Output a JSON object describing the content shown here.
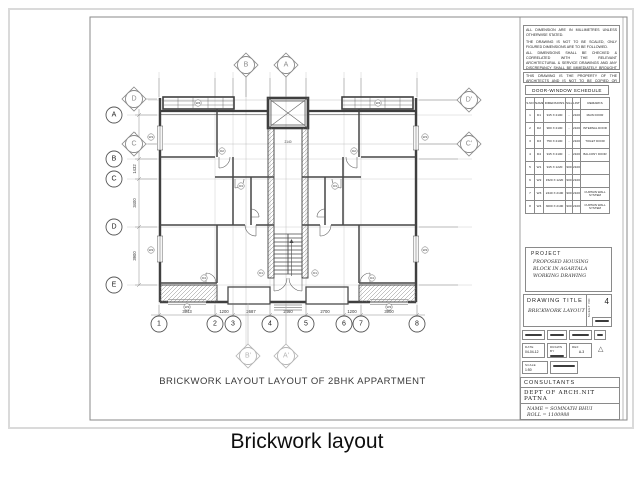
{
  "caption": "Brickwork layout",
  "colors": {
    "line": "#3f3f3f",
    "grid": "#b8b8b8",
    "marker_gray": "#8a8a8a",
    "marker_light": "#b5b5b5",
    "scan_border": "#dadada"
  },
  "sheet": {
    "plan_title": "BRICKWORK LAYOUT  LAYOUT OF 2BHK APPARTMENT",
    "notes_block1": [
      "ALL DIMENSION ARE IN MILLIMETRES UNLESS OTHERWISE STATED.",
      "THE DRAWING IS NOT TO BE SCALED, ONLY FIGURED DIMENSIONS ARE TO BE FOLLOWED.",
      "ALL DIMENSIONS SHALL BE CHECKED & CORRELATED WITH THE RELEVANT ARCHITECTURAL & SERVICE DRAWINGS AND ANY DISCREPANCY SHALL BE IMMEDIATELY BROUGHT TO THE NOTICE OF THE ARCHITECT BEFORE COMMENCEMENT OF THE WORK AT SITE."
    ],
    "notes_block2": "THIS DRAWING IS THE PROPERTY OF THE ARCHITECTS AND IS NOT TO BE COPIED OR REPRODUCED WITHOUT WRITTEN PERMISSION.",
    "schedule": {
      "title": "DOOR-WINDOW SCHEDULE",
      "columns": [
        "S.NO",
        "NAME",
        "DIMENSIONS",
        "SILL",
        "LINTEL",
        "REMARKS"
      ],
      "rows": [
        [
          "1",
          "D1",
          "915 X 2100",
          "-",
          "2100",
          "MAIN DOOR"
        ],
        [
          "2",
          "D2",
          "900 X 2100",
          "-",
          "2100",
          "INTERNAL DOOR"
        ],
        [
          "3",
          "D3",
          "750 X 2100",
          "-",
          "2100",
          "TOILET DOOR"
        ],
        [
          "4",
          "D4",
          "915 X 2100",
          "-",
          "2100",
          "BALCONY DOOR"
        ],
        [
          "5",
          "W1",
          "915 X 1220",
          "900",
          "2100",
          ""
        ],
        [
          "6",
          "W2",
          "1520 X 1220",
          "900",
          "2100",
          ""
        ],
        [
          "7",
          "W3",
          "2440 X 2100",
          "900",
          "2100",
          "CURTAIN WALL SYSTEM"
        ],
        [
          "8",
          "W4",
          "3000 X 2100",
          "900",
          "2100",
          "CURTAIN WALL SYSTEM"
        ]
      ]
    },
    "project": {
      "label": "PROJECT",
      "lines": [
        "PROPOSED HOUSING",
        "BLOCK IN AGARTALA",
        "WORKING DRAWING"
      ]
    },
    "drawing_title": {
      "label": "DRAWING TITLE",
      "title": "BRICKWORK LAYOUT",
      "sheet_no": "4",
      "sheet_no_label": "SHEET NO"
    },
    "revision": {
      "date_label": "DATE",
      "date": "04-04-12",
      "drawn_label": "DRAWN BY",
      "ref_label": "REF",
      "ref": "A-3",
      "scale_label": "SCALE",
      "scale": "1:50"
    },
    "consultants": {
      "label": "CONSULTANTS",
      "dept": "DEPT OF ARCH.NIT PATNA",
      "name_line": "NAME = SOMNATH BHUI",
      "roll_line": "ROLL = 1100988",
      "sem_line": "SEM. = 8"
    },
    "grid": {
      "bottom": [
        {
          "label": "1",
          "x": 149
        },
        {
          "label": "2",
          "x": 205
        },
        {
          "label": "3",
          "x": 223
        },
        {
          "label": "4",
          "x": 260
        },
        {
          "label": "5",
          "x": 296
        },
        {
          "label": "6",
          "x": 334
        },
        {
          "label": "7",
          "x": 351
        },
        {
          "label": "8",
          "x": 407
        }
      ],
      "left": [
        {
          "label": "A",
          "y": 105
        },
        {
          "label": "B",
          "y": 149
        },
        {
          "label": "C",
          "y": 169
        },
        {
          "label": "D",
          "y": 217
        },
        {
          "label": "E",
          "y": 275
        }
      ],
      "sections": [
        {
          "label": "D",
          "x": 124,
          "y": 89,
          "lx": 147,
          "ly": 89,
          "tone": "dark"
        },
        {
          "label": "C",
          "x": 124,
          "y": 134,
          "lx": 147,
          "ly": 134,
          "tone": "dark"
        },
        {
          "label": "B",
          "x": 236,
          "y": 55,
          "lx": 236,
          "ly": 87,
          "tone": "dark"
        },
        {
          "label": "A",
          "x": 276,
          "y": 55,
          "lx": 276,
          "ly": 87,
          "tone": "dark"
        },
        {
          "label": "D'",
          "x": 459,
          "y": 90,
          "lx": 409,
          "ly": 90,
          "tone": "dark"
        },
        {
          "label": "C'",
          "x": 459,
          "y": 134,
          "lx": 409,
          "ly": 134,
          "tone": "dark"
        },
        {
          "label": "B'",
          "x": 238,
          "y": 346,
          "lx": 238,
          "ly": 293,
          "tone": "light"
        },
        {
          "label": "A'",
          "x": 276,
          "y": 346,
          "lx": 276,
          "ly": 293,
          "tone": "light"
        }
      ]
    },
    "dimensions": {
      "bottom": [
        {
          "label": "3943",
          "x": 177
        },
        {
          "label": "1200",
          "x": 214
        },
        {
          "label": "2687",
          "x": 241
        },
        {
          "label": "2460",
          "x": 278
        },
        {
          "label": "2700",
          "x": 315
        },
        {
          "label": "1200",
          "x": 342
        },
        {
          "label": "3900",
          "x": 379
        }
      ],
      "left": [
        {
          "label": "3172",
          "y": 127
        },
        {
          "label": "1432",
          "y": 159
        },
        {
          "label": "3400",
          "y": 193
        },
        {
          "label": "3900",
          "y": 246
        }
      ],
      "inplan": [
        {
          "label": "2140",
          "x": 278,
          "y": 133
        }
      ]
    },
    "fixtures": [
      {
        "label": "W4",
        "x": 188,
        "y": 93
      },
      {
        "label": "W4",
        "x": 368,
        "y": 93
      },
      {
        "label": "D2",
        "x": 212,
        "y": 141
      },
      {
        "label": "D2",
        "x": 344,
        "y": 141
      },
      {
        "label": "D3",
        "x": 231,
        "y": 176
      },
      {
        "label": "D3",
        "x": 325,
        "y": 176
      },
      {
        "label": "W1",
        "x": 141,
        "y": 127
      },
      {
        "label": "W1",
        "x": 415,
        "y": 127
      },
      {
        "label": "W2",
        "x": 141,
        "y": 240
      },
      {
        "label": "W2",
        "x": 415,
        "y": 240
      },
      {
        "label": "D1",
        "x": 251,
        "y": 263
      },
      {
        "label": "D1",
        "x": 305,
        "y": 263
      },
      {
        "label": "D4",
        "x": 194,
        "y": 268
      },
      {
        "label": "D4",
        "x": 362,
        "y": 268
      },
      {
        "label": "W3",
        "x": 177,
        "y": 297
      },
      {
        "label": "W3",
        "x": 379,
        "y": 297
      }
    ]
  }
}
